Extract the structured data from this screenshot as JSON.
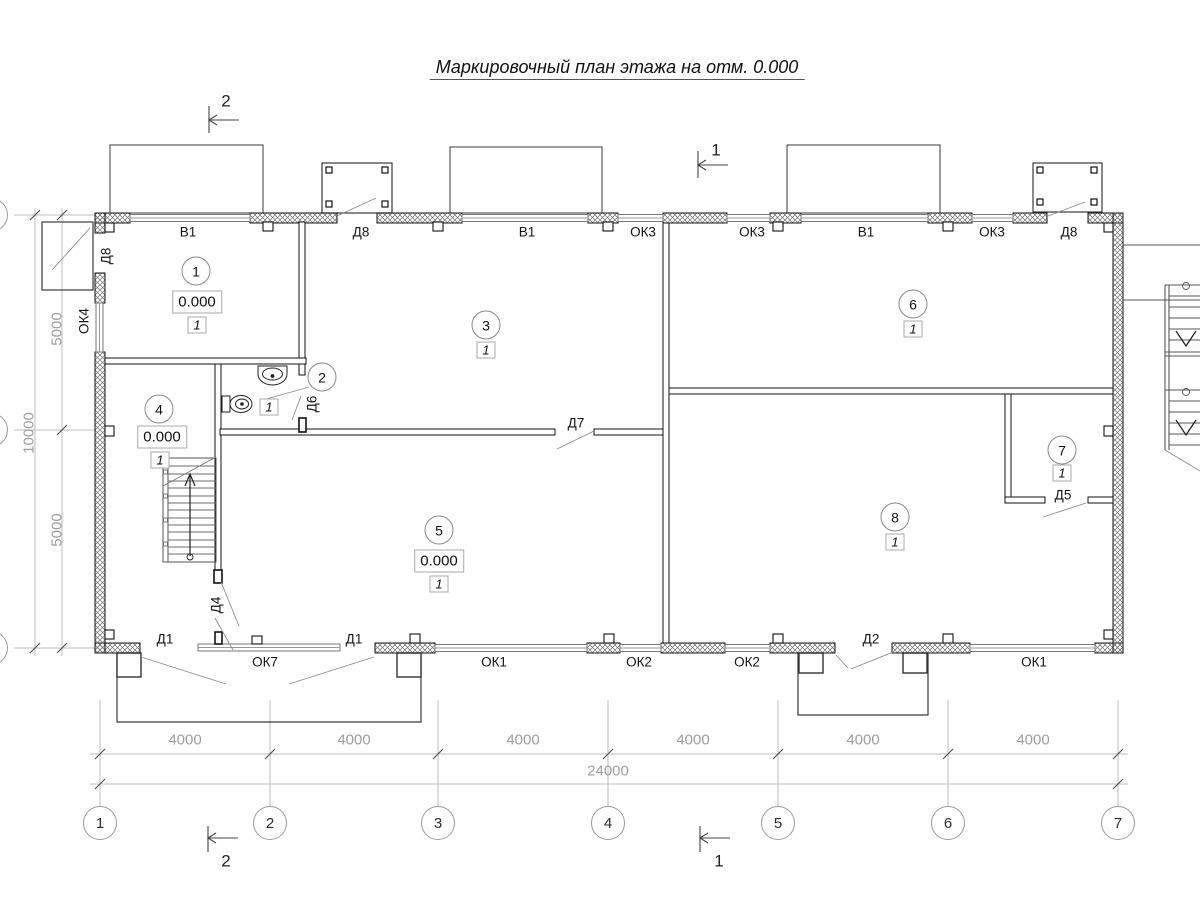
{
  "title": "Маркировочный план этажа на отм. 0.000",
  "sections": {
    "top_left": "2",
    "top_right": "1",
    "bottom_left": "2",
    "bottom_right": "1"
  },
  "axes": [
    "1",
    "2",
    "3",
    "4",
    "5",
    "6",
    "7"
  ],
  "dims": {
    "bays": [
      "4000",
      "4000",
      "4000",
      "4000",
      "4000",
      "4000"
    ],
    "total": "24000",
    "left_top": "5000",
    "left_total": "10000",
    "left_bottom": "5000"
  },
  "openings": {
    "top": [
      "В1",
      "Д8",
      "В1",
      "ОК3",
      "ОК3",
      "В1",
      "ОК3",
      "Д8"
    ],
    "left_door": "Д8",
    "left_window": "ОК4",
    "bottom_doors": [
      "Д1",
      "Д1",
      "Д2"
    ],
    "bottom_windows": [
      "ОК7",
      "ОК1",
      "ОК2",
      "ОК2",
      "ОК1"
    ],
    "interior_doors": [
      "Д6",
      "Д7",
      "Д4",
      "Д5"
    ]
  },
  "rooms": [
    {
      "number": "1",
      "elevation": "0.000",
      "finish": "1"
    },
    {
      "number": "2",
      "finish": "1"
    },
    {
      "number": "3",
      "finish": "1"
    },
    {
      "number": "4",
      "elevation": "0.000",
      "finish": "1"
    },
    {
      "number": "5",
      "elevation": "0.000",
      "finish": "1"
    },
    {
      "number": "6",
      "finish": "1"
    },
    {
      "number": "7",
      "finish": "1"
    },
    {
      "number": "8",
      "finish": "1"
    }
  ],
  "colors": {
    "line": "#1c1c1c",
    "dim": "#9d9d9d",
    "hatch": "#6e6e6e"
  }
}
